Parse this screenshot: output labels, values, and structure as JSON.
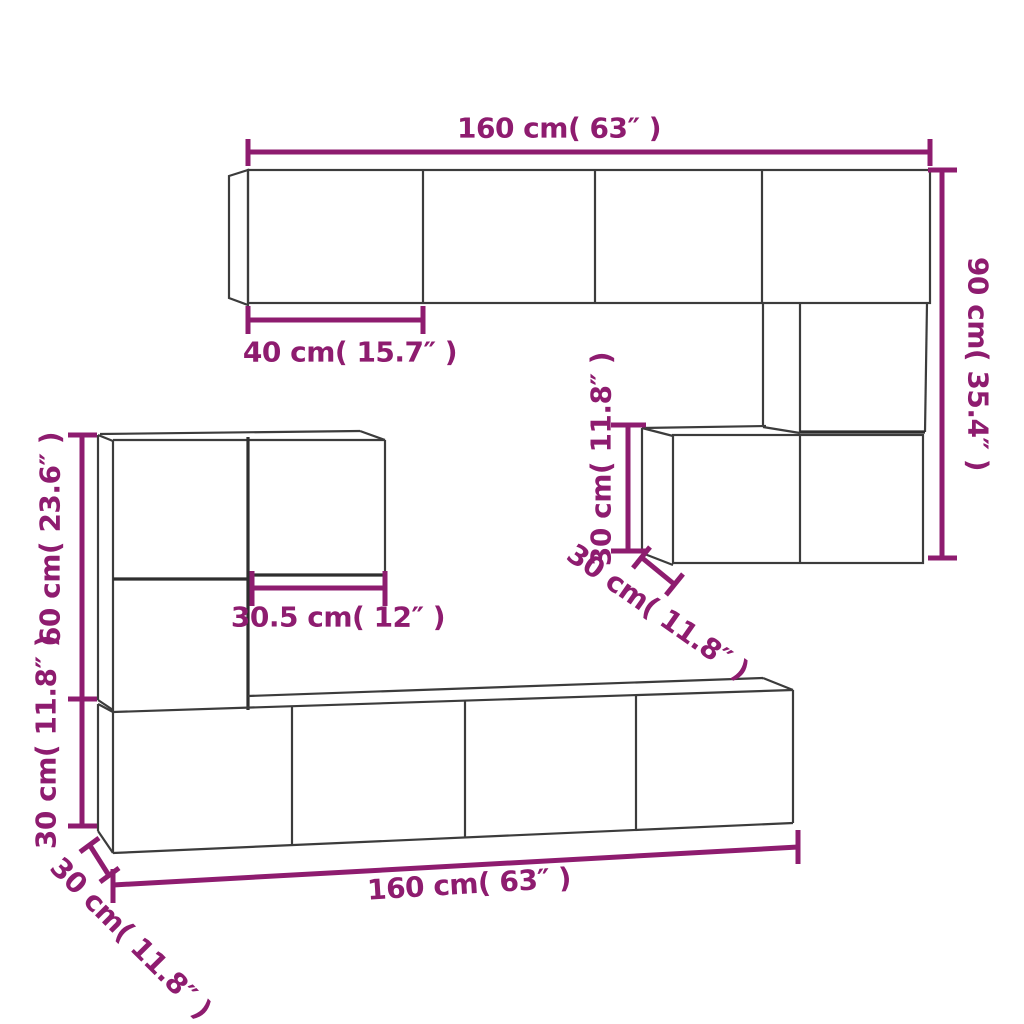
{
  "diagram_type": "furniture-dimension-drawing",
  "colors": {
    "dimension_accent": "#8e1c6f",
    "outline": "#3c3c3c",
    "background": "#ffffff"
  },
  "dimensions": {
    "top_cabinet_width": "160 cm( 63″ )",
    "top_cabinet_door_width": "40 cm( 15.7″ )",
    "right_column_height": "90 cm( 35.4″ )",
    "right_cabinet_height": "30 cm( 11.8″ )",
    "right_cabinet_depth": "30 cm( 11.8″ )",
    "left_cabinet_height": "60 cm( 23.6″ )",
    "bench_height": "30 cm( 11.8″ )",
    "hanging_cabinet_width": "30.5 cm( 12″ )",
    "bench_width": "160 cm( 63″ )",
    "bench_depth": "30 cm( 11.8″ )"
  }
}
